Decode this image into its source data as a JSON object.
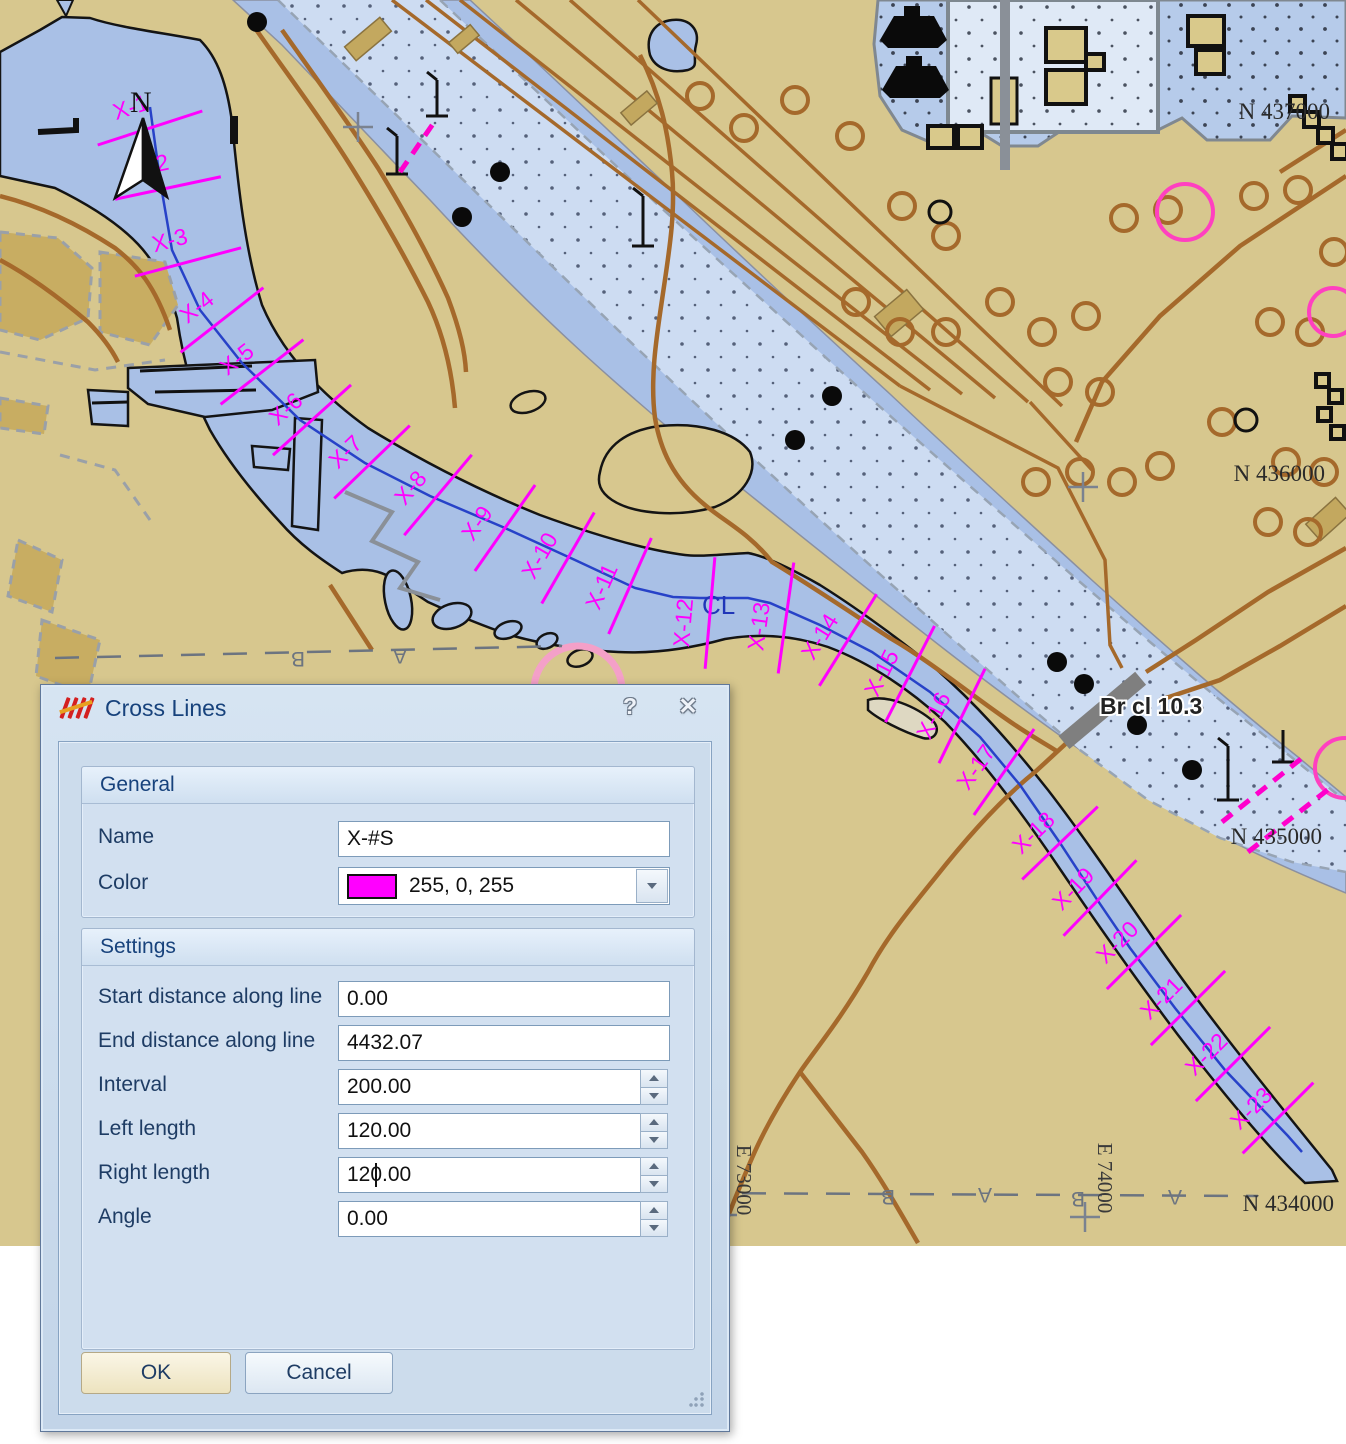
{
  "colors": {
    "magenta": "#ff00ff",
    "water": "#a9c0e6",
    "land": "#d7c78e",
    "lane": "#cddcf2",
    "road": "#a5692b",
    "centerline": "#2742c8",
    "navy": "#17427c",
    "dialogbg": "#ccdcec"
  },
  "window": {
    "title": "Cross Lines",
    "icon": "cross-lines-icon",
    "help_glyph": "?",
    "close_glyph": "✕"
  },
  "dialog": {
    "general": {
      "header": "General",
      "name_label": "Name",
      "name_value": "X-#S",
      "color_label": "Color",
      "color_value": "255, 0, 255",
      "color_hex": "#ff00ff"
    },
    "settings": {
      "header": "Settings",
      "rows": [
        {
          "label": "Start distance along line",
          "value": "0.00",
          "spinner": false
        },
        {
          "label": "End distance along line",
          "value": "4432.07",
          "spinner": false
        },
        {
          "label": "Interval",
          "value": "200.00",
          "spinner": true
        },
        {
          "label": "Left length",
          "value": "120.00",
          "spinner": true
        },
        {
          "label": "Right length",
          "value": "120.00",
          "spinner": true,
          "caret": true
        },
        {
          "label": "Angle",
          "value": "0.00",
          "spinner": true
        }
      ]
    },
    "buttons": {
      "ok": "OK",
      "cancel": "Cancel"
    }
  },
  "map": {
    "north_label": "N",
    "centerline_label": {
      "text": "CL",
      "x": 702,
      "y": 614
    },
    "bridge_label": {
      "text": "Br cl 10.3",
      "x": 1100,
      "y": 714
    },
    "grid_labels": [
      {
        "text": "N 437000",
        "x": 1330,
        "y": 119
      },
      {
        "text": "N 436000",
        "x": 1325,
        "y": 481
      },
      {
        "text": "N 435000",
        "x": 1322,
        "y": 844
      },
      {
        "text": "N 434000",
        "x": 1334,
        "y": 1211
      }
    ],
    "easting_labels": [
      {
        "text": "E 73000",
        "x": 737,
        "y": 1180
      },
      {
        "text": "E 74000",
        "x": 1098,
        "y": 1178
      }
    ],
    "boundary_lines": [
      {
        "x1": 55,
        "y1": 658,
        "x2": 562,
        "y2": 646,
        "letters": [
          {
            "t": "B",
            "x": 298,
            "y": 652
          },
          {
            "t": "A",
            "x": 400,
            "y": 649
          }
        ]
      },
      {
        "x1": 700,
        "y1": 1193,
        "x2": 1258,
        "y2": 1196,
        "letters": [
          {
            "t": "B",
            "x": 888,
            "y": 1190
          },
          {
            "t": "A",
            "x": 985,
            "y": 1188
          },
          {
            "t": "B",
            "x": 1078,
            "y": 1192
          },
          {
            "t": "A",
            "x": 1175,
            "y": 1190
          }
        ]
      }
    ],
    "centerline": [
      [
        150,
        107
      ],
      [
        160,
        180
      ],
      [
        172,
        250
      ],
      [
        200,
        310
      ],
      [
        242,
        363
      ],
      [
        300,
        420
      ],
      [
        365,
        463
      ],
      [
        430,
        496
      ],
      [
        505,
        528
      ],
      [
        575,
        560
      ],
      [
        635,
        588
      ],
      [
        673,
        597
      ],
      [
        700,
        598
      ],
      [
        748,
        598
      ],
      [
        770,
        603
      ],
      [
        820,
        625
      ],
      [
        872,
        652
      ],
      [
        930,
        692
      ],
      [
        980,
        737
      ],
      [
        1020,
        785
      ],
      [
        1060,
        843
      ],
      [
        1096,
        898
      ],
      [
        1130,
        948
      ],
      [
        1175,
        1008
      ],
      [
        1225,
        1070
      ],
      [
        1288,
        1136
      ],
      [
        1302,
        1152
      ]
    ],
    "crosslines": [
      {
        "label": "X-1",
        "x": 150,
        "y": 128,
        "angle": -18,
        "len": 110
      },
      {
        "label": "X-2",
        "x": 168,
        "y": 188,
        "angle": -12,
        "len": 108
      },
      {
        "label": "X-3",
        "x": 188,
        "y": 262,
        "angle": -15,
        "len": 110
      },
      {
        "label": "X-4",
        "x": 222,
        "y": 320,
        "angle": -38,
        "len": 105
      },
      {
        "label": "X-5",
        "x": 262,
        "y": 372,
        "angle": -38,
        "len": 105
      },
      {
        "label": "X-6",
        "x": 312,
        "y": 420,
        "angle": -42,
        "len": 105
      },
      {
        "label": "X-7",
        "x": 372,
        "y": 462,
        "angle": -44,
        "len": 105
      },
      {
        "label": "X-8",
        "x": 438,
        "y": 495,
        "angle": -50,
        "len": 105
      },
      {
        "label": "X-9",
        "x": 505,
        "y": 528,
        "angle": -55,
        "len": 105
      },
      {
        "label": "X-10",
        "x": 568,
        "y": 558,
        "angle": -60,
        "len": 105
      },
      {
        "label": "X-11",
        "x": 630,
        "y": 586,
        "angle": -66,
        "len": 105
      },
      {
        "label": "X-12",
        "x": 710,
        "y": 613,
        "angle": -85,
        "len": 112
      },
      {
        "label": "X-13",
        "x": 786,
        "y": 618,
        "angle": -82,
        "len": 112
      },
      {
        "label": "X-14",
        "x": 848,
        "y": 640,
        "angle": -58,
        "len": 108
      },
      {
        "label": "X-15",
        "x": 910,
        "y": 674,
        "angle": -63,
        "len": 108
      },
      {
        "label": "X-16",
        "x": 962,
        "y": 716,
        "angle": -64,
        "len": 105
      },
      {
        "label": "X-17",
        "x": 1004,
        "y": 772,
        "angle": -55,
        "len": 105
      },
      {
        "label": "X-18",
        "x": 1060,
        "y": 843,
        "angle": -44,
        "len": 105
      },
      {
        "label": "X-19",
        "x": 1100,
        "y": 898,
        "angle": -46,
        "len": 105
      },
      {
        "label": "X-20",
        "x": 1144,
        "y": 952,
        "angle": -45,
        "len": 105
      },
      {
        "label": "X-21",
        "x": 1188,
        "y": 1008,
        "angle": -45,
        "len": 105
      },
      {
        "label": "X-22",
        "x": 1233,
        "y": 1064,
        "angle": -45,
        "len": 105
      },
      {
        "label": "X-23",
        "x": 1278,
        "y": 1118,
        "angle": -45,
        "len": 100
      }
    ]
  }
}
